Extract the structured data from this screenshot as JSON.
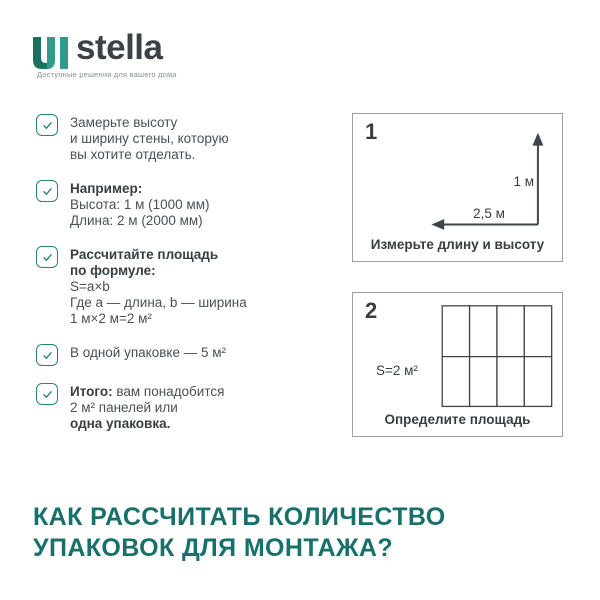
{
  "colors": {
    "teal": "#2A837B",
    "heading": "#17706A",
    "brand": "#3B4145",
    "tagline": "#8A9094",
    "text": "#4A5054",
    "dark": "#383E42",
    "border": "#9BA1A5",
    "line": "#3E4448",
    "logo-dark": "#1F6E5E",
    "logo-light": "#2F9B8A"
  },
  "logo": {
    "brand": "stella",
    "tagline": "Доступные решения для вашего дома"
  },
  "checklist": [
    {
      "lines": [
        [
          {
            "t": "Замерьте высоту",
            "b": false
          }
        ],
        [
          {
            "t": "и ширину стены, которую",
            "b": false
          }
        ],
        [
          {
            "t": "вы хотите отделать.",
            "b": false
          }
        ]
      ]
    },
    {
      "lines": [
        [
          {
            "t": "Например:",
            "b": true
          }
        ],
        [
          {
            "t": "Высота: 1 м (1000 мм)",
            "b": false
          }
        ],
        [
          {
            "t": "Длина: 2 м (2000 мм)",
            "b": false
          }
        ]
      ]
    },
    {
      "lines": [
        [
          {
            "t": "Рассчитайте площадь",
            "b": true
          }
        ],
        [
          {
            "t": "по формуле:",
            "b": true
          }
        ],
        [
          {
            "t": "S=a×b",
            "b": false
          }
        ],
        [
          {
            "t": "Где a — длина, b — ширина",
            "b": false
          }
        ],
        [
          {
            "t": "1 м×2 м=2 м²",
            "b": false
          }
        ]
      ]
    },
    {
      "lines": [
        [
          {
            "t": "В одной упаковке — 5 м²",
            "b": false
          }
        ]
      ]
    },
    {
      "lines": [
        [
          {
            "t": "Итого:",
            "b": true
          },
          {
            "t": " вам понадобится",
            "b": false
          }
        ],
        [
          {
            "t": "2 м² панелей или",
            "b": false
          }
        ],
        [
          {
            "t": "одна упаковка.",
            "b": true
          }
        ]
      ]
    }
  ],
  "steps": [
    {
      "number": "1",
      "height_label": "1 м",
      "width_label": "2,5 м",
      "caption": "Измерьте длину и высоту"
    },
    {
      "number": "2",
      "area_label": "S=2 м²",
      "caption": "Определите площадь"
    }
  ],
  "heading": {
    "line1": "КАК РАССЧИТАТЬ КОЛИЧЕСТВО",
    "line2": "УПАКОВОК ДЛЯ МОНТАЖА?"
  }
}
